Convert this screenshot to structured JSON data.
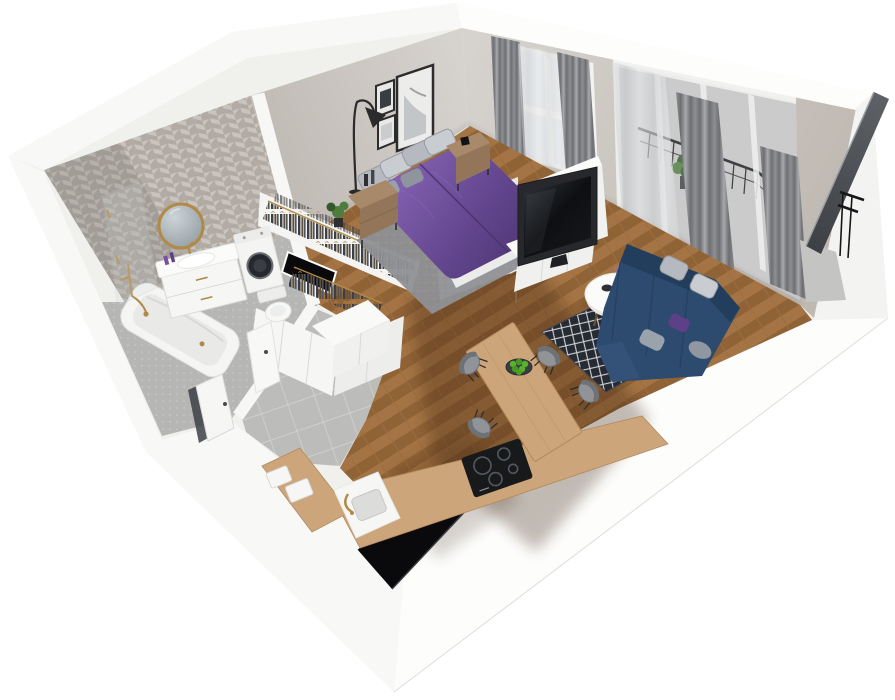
{
  "scene": {
    "kind": "3d-apartment-floorplan-render",
    "view": "isometric-cutaway-perspective",
    "background": "#ffffff"
  },
  "palette": {
    "bg": "#ffffff",
    "shell": "#f0f0ed",
    "band": "#f8f8f6",
    "band_bright": "#fdfdfc",
    "band_right": "#f3f3f1",
    "edge": "#dddddb",
    "greige_a": "#d6d2cd",
    "greige_b": "#bfb9b2",
    "greige_dark": "#a9a29b",
    "tile_a": "#c9c4bd",
    "tile_b": "#b1aba4",
    "bath_floor": "#b6b7b5",
    "bath_dot": "#cbccca",
    "hall_tile": "#bcbdbb",
    "hall_grout": "#d4d5d3",
    "wood": "#9c6e3f",
    "wood_light": "#ad7c49",
    "wood_dark": "#81552e",
    "floor_shadow": "#3a2208",
    "counter_wood": "#cda57a",
    "counter_edge": "#b28a5e",
    "white_furn": "#f6f6f4",
    "white_shade": "#e9e9e7",
    "seam": "#d9d9d7",
    "purple": "#64478f",
    "purple_light": "#8a68bb",
    "purple_dark": "#4a3370",
    "pillow_a": "#b6bac0",
    "pillow_b": "#c9cdd2",
    "pillow_edge": "#969ba1",
    "navy": "#2d4b6e",
    "navy_dark": "#223e5c",
    "navy_light": "#3a5a80",
    "rug_dark": "#262a33",
    "rug_line": "#d6d6da",
    "rug_bedroom": "#8f9095",
    "curtain_dark": "#6e6f73",
    "curtain_mid": "#8e8f93",
    "curtain_light": "#a8a9ad",
    "sheer": "#e3e5e7",
    "glass": "#e9ecee",
    "gold": "#b08a46",
    "black": "#0a0a0c",
    "tv_panel": "#26282b",
    "tv_screen": "#0d0f12",
    "metal_dark": "#1a1a1c",
    "panel_gray": "#3c3f44",
    "panel_gray_light": "#5d6065",
    "green": "#4e7c3e",
    "green_dark": "#35582a",
    "apple": "#57b22d",
    "nstand": "#a8896a",
    "nstand_dark": "#93765a",
    "chair_gray": "#909398",
    "chair_dark": "#6e7176",
    "concrete": "#c4c4c2",
    "machine_door": "#25282c",
    "cloth_a": "#3a3f49",
    "cloth_b": "#615039",
    "cloth_c": "#50555c"
  },
  "rooms": {
    "bathroom": {
      "label": "bathroom",
      "floor": "gray-tile-speckled",
      "wall": "herringbone-tile",
      "furniture": [
        "bathtub",
        "shower-glass-screen",
        "round-gold-mirror",
        "vanity-with-sink",
        "washing-machine",
        "toilet",
        "bathroom-door"
      ]
    },
    "wardrobe": {
      "label": "walk-in-wardrobe",
      "floor": "gray-tile",
      "furniture": [
        "open-clothes-rail-long",
        "open-clothes-rail-short",
        "wardrobe-cabinets",
        "dark-shaft-opening"
      ]
    },
    "bedroom": {
      "label": "bedroom",
      "floor": "wood-herringbone-with-rug",
      "wall": "greige-plaster",
      "furniture": [
        "double-bed-purple-duvet",
        "gray-pillows",
        "nightstand-left",
        "nightstand-right",
        "floor-lamp",
        "wall-art-frames",
        "window-with-curtains",
        "potted-plant"
      ]
    },
    "living_room": {
      "label": "living-room",
      "floor": "wood-herringbone",
      "furniture": [
        "navy-sectional-sofa",
        "throw-pillows",
        "round-coffee-table",
        "diamond-pattern-rug",
        "tv-media-panel",
        "tv-sideboard",
        "balcony-door-curtains"
      ]
    },
    "balcony": {
      "label": "balcony",
      "floor": "concrete",
      "furniture": [
        "metal-railing",
        "balcony-plant",
        "dark-glass-side-panel"
      ]
    },
    "kitchen": {
      "label": "kitchen-dining",
      "floor": "wood-herringbone",
      "furniture": [
        "l-shaped-counter",
        "induction-hob",
        "kitchen-sink-gold-faucet",
        "dining-table",
        "dining-chair-1",
        "dining-chair-2",
        "dining-chair-3",
        "dining-chair-4",
        "apple-bowl",
        "counter-boxes",
        "dark-window-opening",
        "tall-white-cabinet"
      ]
    },
    "hallway": {
      "label": "entrance-hall",
      "floor": "gray-tile",
      "furniture": [
        "entrance-door"
      ]
    }
  }
}
